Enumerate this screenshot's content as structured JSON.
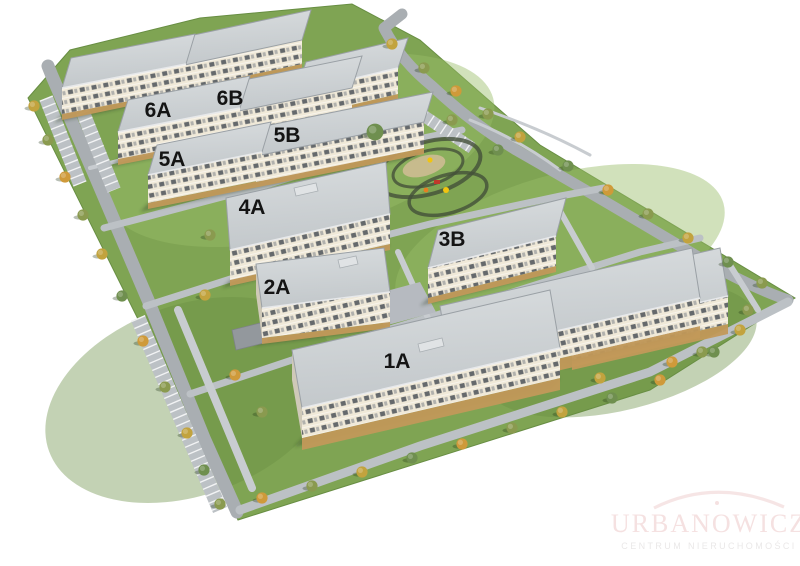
{
  "buildings": [
    {
      "label": "6A"
    },
    {
      "label": "6B"
    },
    {
      "label": "6C"
    },
    {
      "label": "5A"
    },
    {
      "label": "5B"
    },
    {
      "label": "4A"
    },
    {
      "label": "2A"
    },
    {
      "label": "3B"
    },
    {
      "label": "1A"
    },
    {
      "label": "1B"
    },
    {
      "label": "1C"
    }
  ],
  "watermark": {
    "brand": "URBANOWICZ",
    "tagline": "CENTRUM NIERUCHOMOŚCI"
  },
  "colors": {
    "grass": "#7fa453",
    "grass_light": "#9abc68",
    "grass_dark": "#688e43",
    "road": "#a9aeb2",
    "road_light": "#bcc1c5",
    "sidewalk": "#c8ccd0",
    "roof_edge": "#9aa0a5",
    "facade": "#f0e9d8",
    "facade_side": "#cfc9b8",
    "window_dark": "#565b61",
    "ground_tan": "#c2995a",
    "label": "#141414",
    "tree_olive": "#8a9a4f",
    "tree_yellow": "#c2a33e",
    "tree_orange": "#cf9a3a",
    "tree_green": "#6f8f4f",
    "shadow": "rgba(45,62,36,0.38)",
    "ring": "#44503a",
    "sand": "#cdbd92",
    "play_red": "#c0392b",
    "play_yellow": "#f1c40f",
    "play_orange": "#e67e22",
    "wm_pink": "#f5e1e1",
    "wm_gray": "#eae8e8"
  }
}
